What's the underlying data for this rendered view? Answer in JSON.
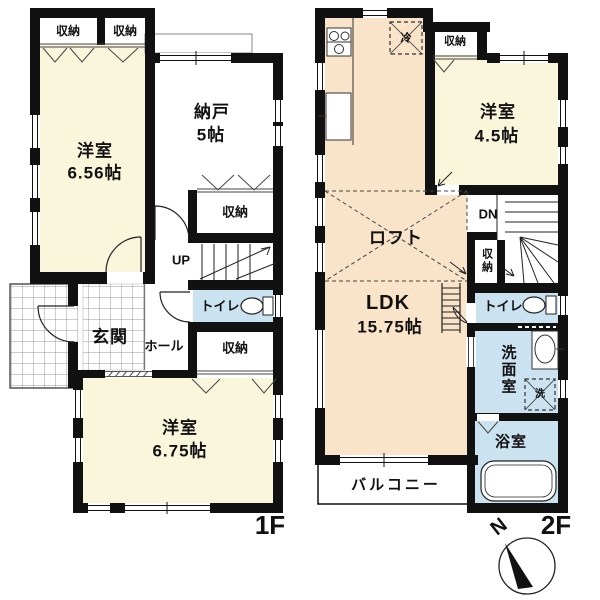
{
  "f1": {
    "label": "1F",
    "closet_a": "収納",
    "closet_b": "収納",
    "room1_name": "洋室",
    "room1_size": "6.56帖",
    "nando_name": "納戸",
    "nando_size": "5帖",
    "closet_mid": "収納",
    "up": "UP",
    "toilet": "トイレ",
    "genkan": "玄関",
    "hall": "ホール",
    "closet_bottom": "収納",
    "room2_name": "洋室",
    "room2_size": "6.75帖"
  },
  "f2": {
    "label": "2F",
    "fridge": "冷",
    "closet_top": "収納",
    "room1_name": "洋室",
    "room1_size": "4.5帖",
    "loft": "ロフト",
    "dn": "DN",
    "closet_mid": "収納",
    "ldk_name": "LDK",
    "ldk_size": "15.75帖",
    "toilet": "トイレ",
    "washroom": "洗面室",
    "washer": "洗",
    "bath": "浴室",
    "balcony": "バルコニー"
  },
  "compass": {
    "north": "N"
  },
  "colors": {
    "room_cream": "#FAF6DC",
    "room_peach": "#F9E3C9",
    "room_blue": "#CBE2F1",
    "wall": "#111111",
    "thin_line": "#333333",
    "tile_line": "#999999",
    "white": "#ffffff"
  },
  "icons": {
    "stove-icon": "gas stove burners (rect + circles)",
    "fridge-icon": "refrigerator (dashed box with X)",
    "toilet-icon": "toilet bowl with tank",
    "sink-icon": "wash basin oval",
    "washer-icon": "washing machine (dashed box with X)",
    "bathtub-icon": "bathtub rounded rectangle",
    "ladder-icon": "loft ladder",
    "compass-icon": "north needle in circle"
  }
}
